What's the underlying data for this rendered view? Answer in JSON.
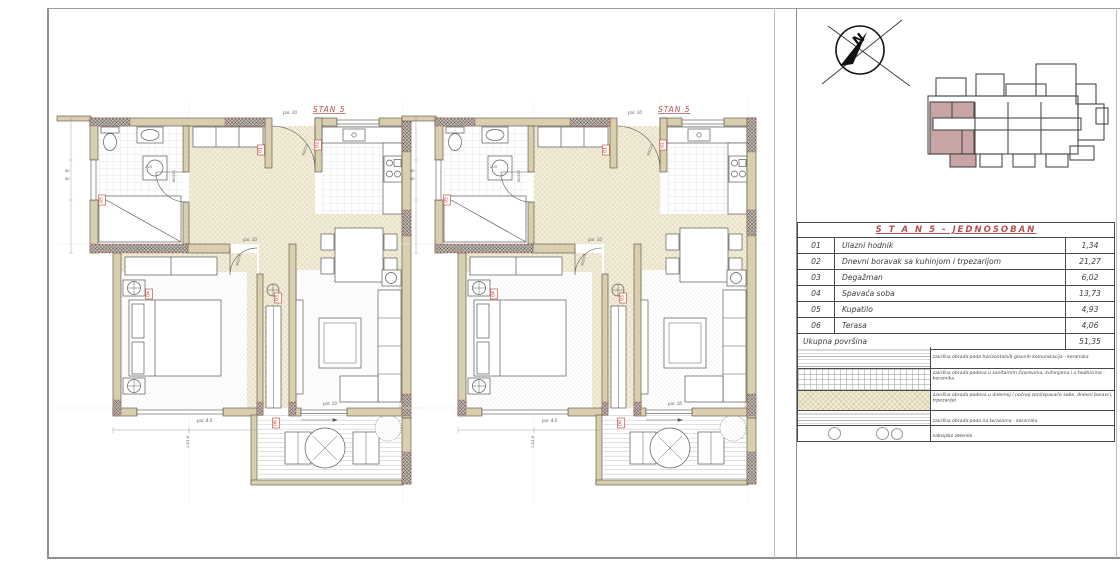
{
  "sheet": {
    "north_label": "N"
  },
  "plans": [
    {
      "label": "STAN 5"
    },
    {
      "label": "STAN 5"
    }
  ],
  "plan_markers": [
    {
      "no": "01",
      "x": 176,
      "y": 38
    },
    {
      "no": "02",
      "x": 233,
      "y": 33
    },
    {
      "no": "03",
      "x": 193,
      "y": 186
    },
    {
      "no": "04",
      "x": 64,
      "y": 182
    },
    {
      "no": "05",
      "x": 17,
      "y": 88
    },
    {
      "no": "06",
      "x": 191,
      "y": 311
    }
  ],
  "plan_annotations": [
    {
      "t": "par. 10",
      "x": 198,
      "y": 2,
      "r": 0,
      "s": 4
    },
    {
      "t": "90/210",
      "x": 219,
      "y": 44,
      "r": -70,
      "s": 3.4
    },
    {
      "t": "80/210",
      "x": 90,
      "y": 70,
      "r": -90,
      "s": 3.4
    },
    {
      "t": "90/210",
      "x": 153,
      "y": 154,
      "r": -75,
      "s": 3.4
    },
    {
      "t": "par. 10",
      "x": 158,
      "y": 129,
      "r": 0,
      "s": 4
    },
    {
      "t": "par. 4.0",
      "x": 112,
      "y": 310,
      "r": 0,
      "s": 4
    },
    {
      "t": "par. 10",
      "x": 238,
      "y": 293,
      "r": 0,
      "s": 4
    },
    {
      "t": "80",
      "x": -20,
      "y": 60,
      "r": 0,
      "s": 3.6
    },
    {
      "t": "80",
      "x": -20,
      "y": 68,
      "r": 0,
      "s": 3.6
    },
    {
      "t": "2.10",
      "x": 60,
      "y": 56,
      "r": 0,
      "s": 3.2
    },
    {
      "t": "1.5/1.8",
      "x": 104,
      "y": 336,
      "r": -90,
      "s": 3.4
    }
  ],
  "panel": {
    "table": {
      "header": "S T A N  5 - JEDNOSOBAN",
      "rows": [
        {
          "no": "01",
          "name": "Ulazni hodnik",
          "value": "1,34"
        },
        {
          "no": "02",
          "name": "Dnevni boravak sa kuhinjom i trpezarijom",
          "value": "21,27"
        },
        {
          "no": "03",
          "name": "Degažman",
          "value": "6,02"
        },
        {
          "no": "04",
          "name": "Spavaća soba",
          "value": "13,73"
        },
        {
          "no": "05",
          "name": "Kupatilo",
          "value": "4,93"
        },
        {
          "no": "06",
          "name": "Terasa",
          "value": "4,06"
        }
      ],
      "total_label": "Ukupna površina",
      "total_value": "51,35"
    },
    "legend": {
      "rows": [
        {
          "pattern": "hlines",
          "text": "završna obrada poda horizontalnih glavnih komunikacija - keramika",
          "h": 21
        },
        {
          "pattern": "grid",
          "text": "završna obrada podova u sanitarnim čvorovima, kuhinjama i u hodnicima - keramika",
          "h": 21
        },
        {
          "pattern": "cross",
          "text": "završna obrada podova u dnevnoj i noćnoj zoni(spavaće sobe, dnevni boravci, trpezarije)",
          "h": 19
        },
        {
          "pattern": "hlines",
          "text": "završna obrada poda na terasama - keramika",
          "h": 14
        },
        {
          "pattern": "circles",
          "text": "saksijsko zelenilo",
          "h": 15
        }
      ]
    }
  },
  "colors": {
    "accent_red": "#b5504e",
    "wall_beige": "#d9cfae",
    "floor_beige": "#f2ecda",
    "keyplan_pink": "#c9a4a4"
  }
}
